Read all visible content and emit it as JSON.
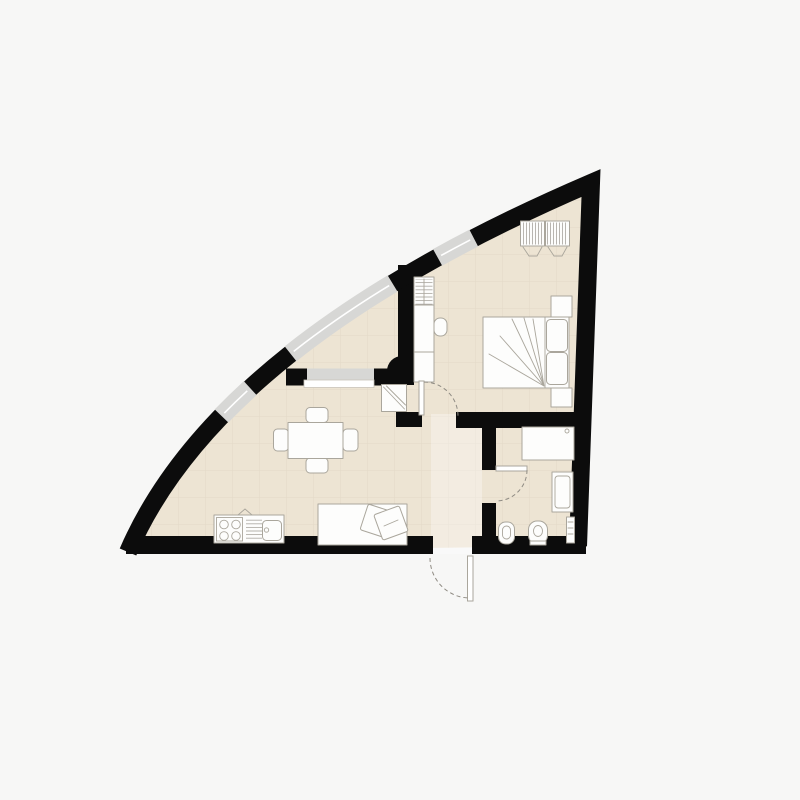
{
  "meta": {
    "type": "architectural-floor-plan",
    "visible_text": [],
    "description_semantic": "one-bedroom apartment plan, quarter-circle curved glazed facade"
  },
  "palette": {
    "bg": "#f7f7f6",
    "floor": "#ede4d3",
    "wall": "#0c0c0c",
    "window_glass": "#d7d7d5",
    "grid_line": "#d8cfbd",
    "furniture_fill": "#fdfdfc",
    "furniture_stroke": "#aaa69c",
    "door_arc": "#8f8b83",
    "corridor_highlight": "#ffffff"
  },
  "plan": {
    "rooms": [
      {
        "id": "living-kitchen",
        "label": "living-kitchen-room",
        "furniture": [
          "dining-table",
          "chair-top",
          "chair-bottom",
          "chair-left",
          "chair-right",
          "daybed",
          "daybed-pillows",
          "kitchen-counter",
          "stove-4-burners",
          "drainboard",
          "sink",
          "tv-corner-unit"
        ]
      },
      {
        "id": "bedroom",
        "label": "bedroom",
        "furniture": [
          "double-bed",
          "pillow-upper",
          "pillow-lower",
          "nightstand-top",
          "nightstand-bottom",
          "hanging-wardrobe-left",
          "hanging-wardrobe-right",
          "shelf-cabinet",
          "wall-knob"
        ]
      },
      {
        "id": "bathroom",
        "label": "bathroom",
        "furniture": [
          "washer-shower-unit",
          "washbasin",
          "bidet",
          "toilet",
          "towel-radiator"
        ]
      },
      {
        "id": "curved-hall",
        "label": "glazed-curve-hall",
        "furniture": []
      }
    ],
    "doors": [
      {
        "id": "entrance-door",
        "swing": "outward-bottom"
      },
      {
        "id": "bedroom-door",
        "swing": "into-corridor"
      },
      {
        "id": "bathroom-door",
        "swing": "into-bathroom"
      }
    ],
    "windows": [
      {
        "id": "facade-window-lower"
      },
      {
        "id": "facade-window-middle"
      },
      {
        "id": "facade-window-upper"
      },
      {
        "id": "partition-window-with-sill"
      }
    ]
  }
}
